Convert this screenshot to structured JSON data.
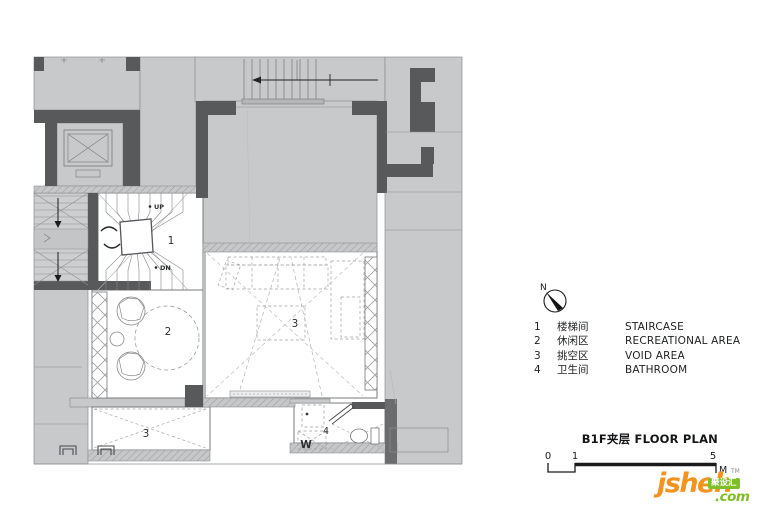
{
  "plan": {
    "labels": {
      "staircase": "1",
      "recreation": "2",
      "void_center": "3",
      "void_lower": "3",
      "bathroom": "4",
      "washer": "W",
      "up": "UP",
      "down": "DN"
    }
  },
  "compass": {
    "north": "N"
  },
  "legend": {
    "items": [
      {
        "num": "1",
        "zh": "楼梯间",
        "en": "STAIRCASE"
      },
      {
        "num": "2",
        "zh": "休闲区",
        "en": "RECREATIONAL AREA"
      },
      {
        "num": "3",
        "zh": "挑空区",
        "en": "VOID AREA"
      },
      {
        "num": "4",
        "zh": "卫生间",
        "en": "BATHROOM"
      }
    ]
  },
  "title": {
    "text": "B1F夹层 FLOOR PLAN"
  },
  "scale_bar": {
    "t0": "0",
    "t1": "1",
    "t5": "5",
    "unit": "M"
  },
  "logo": {
    "brand": "jsheh",
    "tld": ".com",
    "badge": "聚设汇",
    "tm": "TM"
  },
  "colors": {
    "wall": "#58595b",
    "fill": "#c8c9cb",
    "accent_orange": "#f6921e",
    "accent_green": "#7fbe26"
  }
}
